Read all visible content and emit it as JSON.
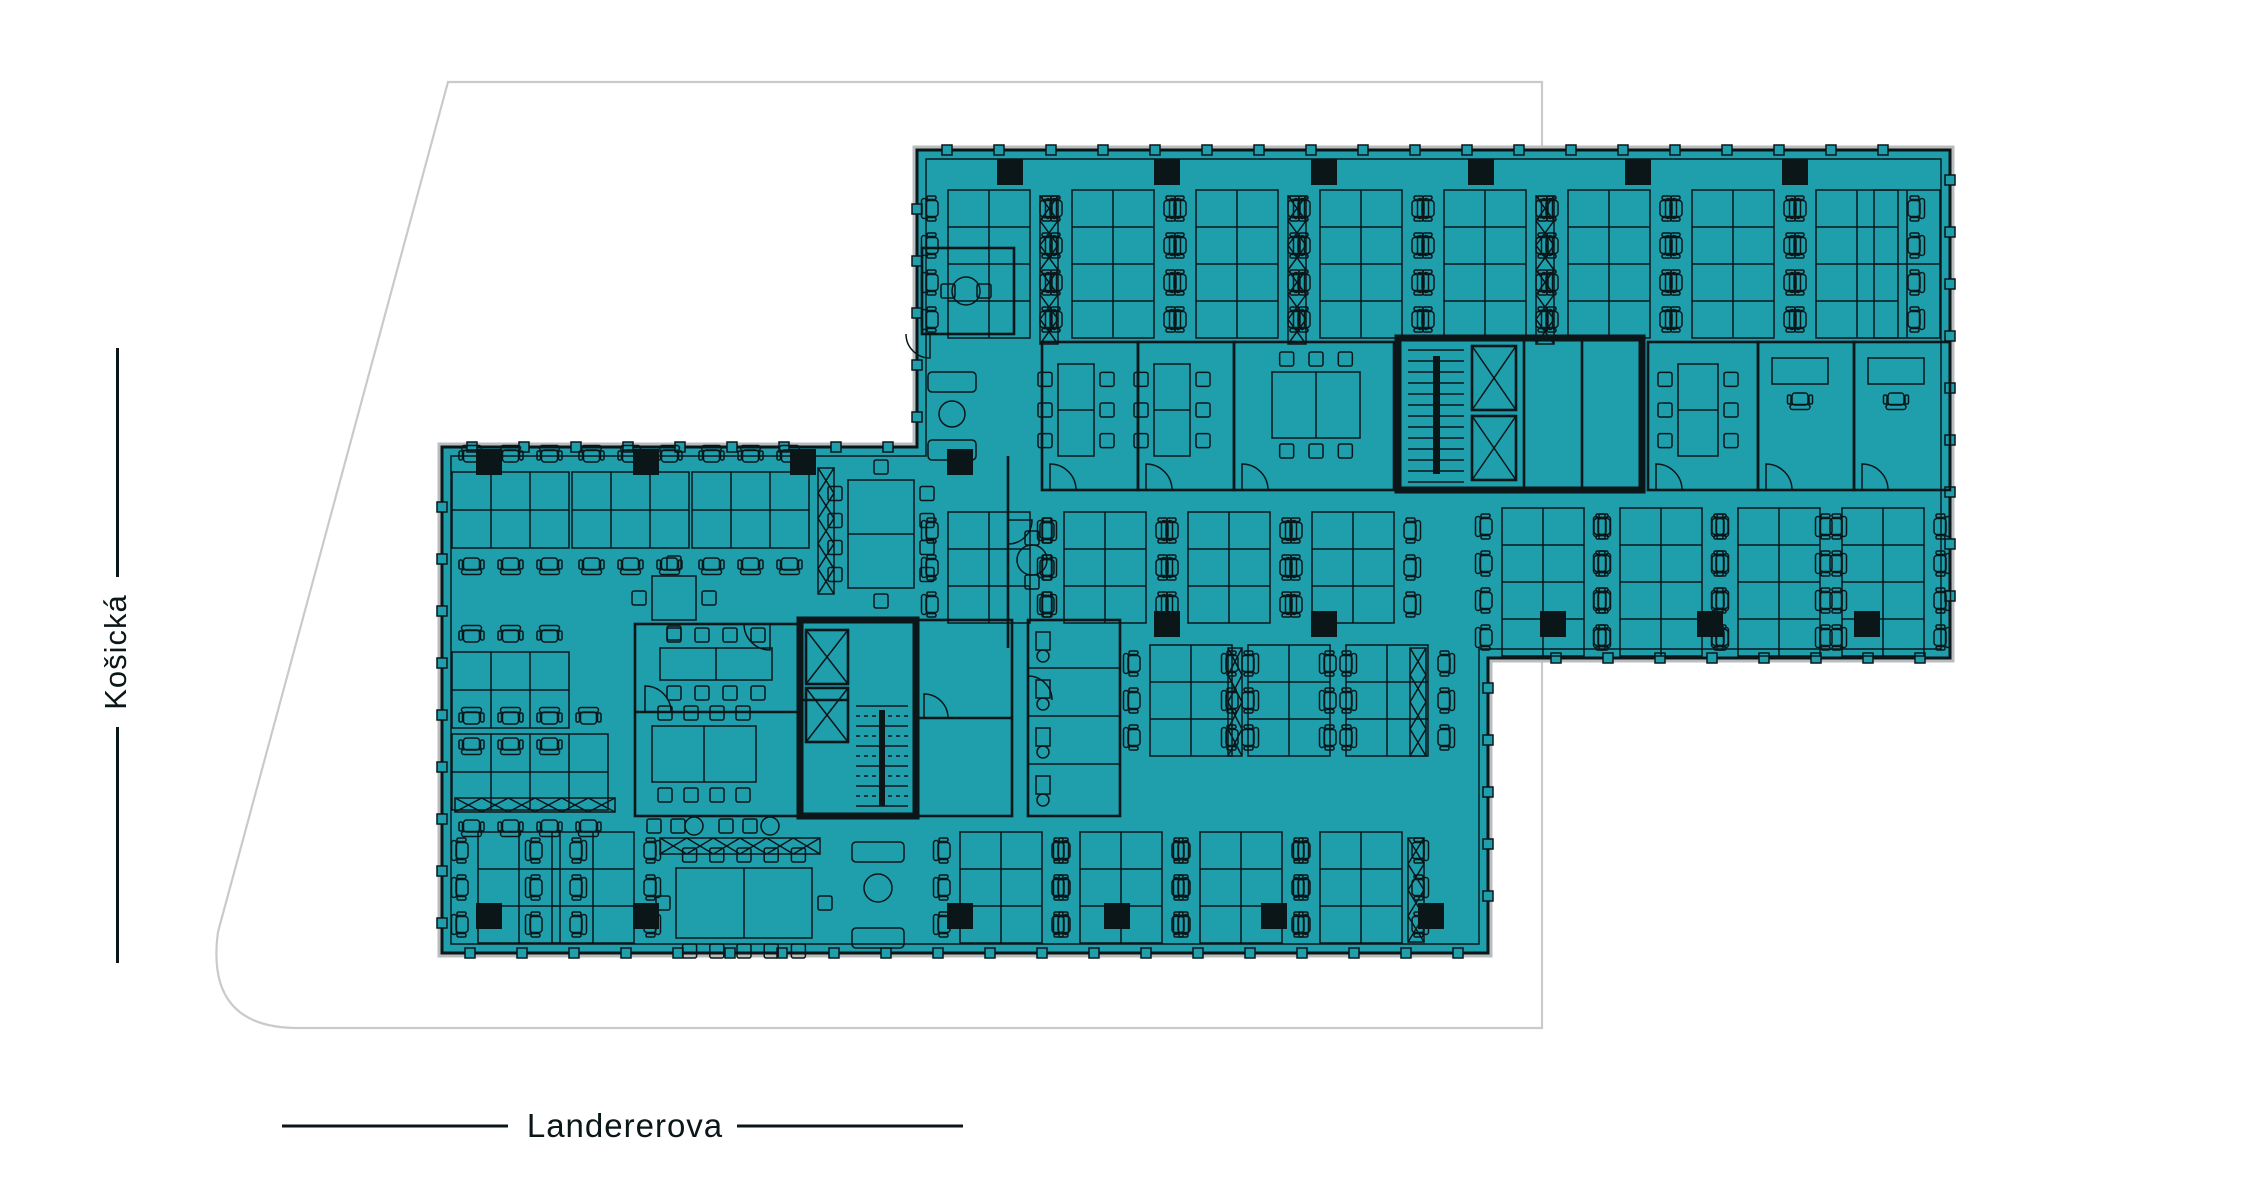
{
  "streets": {
    "west": {
      "label": "Košická"
    },
    "south": {
      "label": "Landererova"
    }
  },
  "colors": {
    "floor_fill": "#1F9EAC",
    "line_ink": "#0B1619",
    "site_outline": "#C8CACC",
    "slab_edge": "#B9BDBF",
    "background": "#FFFFFF"
  }
}
